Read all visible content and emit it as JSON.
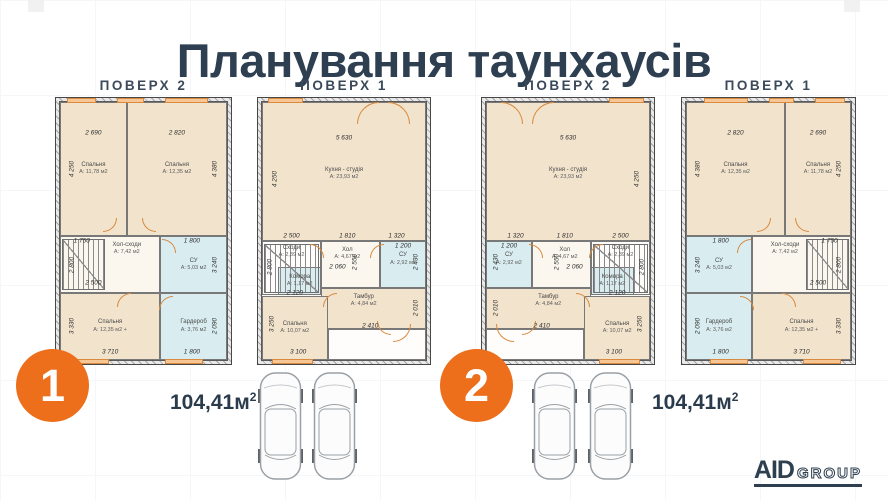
{
  "title": "Планування таунхаусів",
  "brand": {
    "name_bold": "AID",
    "name_outline": "GROUP"
  },
  "units": [
    {
      "badge": "1",
      "area_value": "104,41м",
      "area_sup": "2"
    },
    {
      "badge": "2",
      "area_value": "104,41м",
      "area_sup": "2"
    }
  ],
  "plans": [
    {
      "header": "ПОВЕРХ 2",
      "box": {
        "x": 55,
        "y": 97,
        "w": 177,
        "h": 268
      },
      "stairs": {
        "x": 1,
        "y": 53,
        "w": 26,
        "h": 20
      },
      "rooms": [
        {
          "label": "Спальня",
          "area": "А: 11,78 м2",
          "type": "living",
          "x": 0,
          "y": 0,
          "w": 40,
          "h": 52
        },
        {
          "label": "Спальня",
          "area": "А: 12,35 м2",
          "type": "living",
          "x": 40,
          "y": 0,
          "w": 60,
          "h": 52
        },
        {
          "label": "Хол-сходи",
          "area": "А: 7,42 м2",
          "type": "hall",
          "x": 0,
          "y": 52,
          "w": 60,
          "h": 22,
          "lx": 40,
          "ly": 57
        },
        {
          "label": "СУ",
          "area": "А: 5,03 м2",
          "type": "wet",
          "x": 60,
          "y": 52,
          "w": 40,
          "h": 22
        },
        {
          "label": "Спальня",
          "area": "А: 12,35 м2 +",
          "type": "living",
          "x": 0,
          "y": 74,
          "w": 60,
          "h": 26
        },
        {
          "label": "Гардероб",
          "area": "А: 3,76 м2",
          "type": "wet",
          "x": 60,
          "y": 74,
          "w": 40,
          "h": 26
        }
      ],
      "dims": [
        {
          "t": "2 690",
          "x": 20,
          "y": 12
        },
        {
          "t": "2 820",
          "x": 70,
          "y": 12
        },
        {
          "t": "4 250",
          "x": 7,
          "y": 26,
          "v": 1
        },
        {
          "t": "4 380",
          "x": 93,
          "y": 26,
          "v": 1
        },
        {
          "t": "1 750",
          "x": 13,
          "y": 54
        },
        {
          "t": "1 800",
          "x": 79,
          "y": 54
        },
        {
          "t": "2 800",
          "x": 7,
          "y": 63,
          "v": 1
        },
        {
          "t": "2 500",
          "x": 20,
          "y": 70
        },
        {
          "t": "3 240",
          "x": 93,
          "y": 63,
          "v": 1
        },
        {
          "t": "3 330",
          "x": 7,
          "y": 87,
          "v": 1
        },
        {
          "t": "2 090",
          "x": 93,
          "y": 87,
          "v": 1
        },
        {
          "t": "3 710",
          "x": 30,
          "y": 97
        },
        {
          "t": "1 800",
          "x": 79,
          "y": 97
        }
      ],
      "windows": [
        {
          "s": "top",
          "p": 6,
          "l": 17
        },
        {
          "s": "top",
          "p": 35,
          "l": 15
        },
        {
          "s": "top",
          "p": 62,
          "l": 25
        },
        {
          "s": "bottom",
          "p": 8,
          "l": 22
        },
        {
          "s": "bottom",
          "p": 62,
          "l": 22
        }
      ],
      "doors": [
        {
          "x": 26,
          "y": 45,
          "q": "br"
        },
        {
          "x": 49,
          "y": 45,
          "q": "bl"
        },
        {
          "x": 61,
          "y": 53,
          "q": "tr"
        },
        {
          "x": 34,
          "y": 74,
          "q": "tl"
        },
        {
          "x": 59,
          "y": 75,
          "q": "tl"
        }
      ]
    },
    {
      "header": "ПОВЕРХ 1",
      "box": {
        "x": 257,
        "y": 97,
        "w": 174,
        "h": 268
      },
      "stairs": {
        "x": 1,
        "y": 55,
        "w": 34,
        "h": 19
      },
      "rooms": [
        {
          "label": "Кухня - студія",
          "area": "А: 23,93 м2",
          "type": "living",
          "x": 0,
          "y": 0,
          "w": 100,
          "h": 54,
          "ly": 28
        },
        {
          "label": "Сходи",
          "area": "А: 2,39 м2",
          "type": "open",
          "x": 0,
          "y": 54,
          "w": 36,
          "h": 21,
          "lx": 18,
          "ly": 58
        },
        {
          "label": "Комора",
          "area": "А: 1,17 м2",
          "type": "wet",
          "x": 10,
          "y": 64,
          "w": 26,
          "h": 11
        },
        {
          "label": "Хол",
          "area": "А: 4,67 м2",
          "type": "hall",
          "x": 36,
          "y": 54,
          "w": 36,
          "h": 18,
          "lx": 52,
          "ly": 59
        },
        {
          "label": "СУ",
          "area": "А: 2,92 м2",
          "type": "wet",
          "x": 72,
          "y": 54,
          "w": 28,
          "h": 18,
          "lx": 86,
          "ly": 61
        },
        {
          "label": "Тамбур",
          "area": "А: 4,84 м2",
          "type": "living",
          "x": 36,
          "y": 72,
          "w": 64,
          "h": 16,
          "lx": 62,
          "ly": 77
        },
        {
          "label": "Спальня",
          "area": "А: 10,07 м2",
          "type": "living",
          "x": 0,
          "y": 75,
          "w": 40,
          "h": 25
        },
        {
          "label": "",
          "area": "",
          "type": "open",
          "x": 40,
          "y": 88,
          "w": 60,
          "h": 12
        }
      ],
      "dims": [
        {
          "t": "5 630",
          "x": 50,
          "y": 14
        },
        {
          "t": "4 250",
          "x": 8,
          "y": 30,
          "v": 1
        },
        {
          "t": "2 500",
          "x": 18,
          "y": 52
        },
        {
          "t": "1 810",
          "x": 52,
          "y": 52
        },
        {
          "t": "1 320",
          "x": 82,
          "y": 52
        },
        {
          "t": "1 200",
          "x": 86,
          "y": 56
        },
        {
          "t": "2 800",
          "x": 5,
          "y": 64,
          "v": 1
        },
        {
          "t": "2 550",
          "x": 57,
          "y": 62,
          "v": 1
        },
        {
          "t": "2 060",
          "x": 46,
          "y": 64
        },
        {
          "t": "2 430",
          "x": 94,
          "y": 62,
          "v": 1
        },
        {
          "t": "2 120",
          "x": 20,
          "y": 74
        },
        {
          "t": "2 010",
          "x": 94,
          "y": 80,
          "v": 1
        },
        {
          "t": "2 410",
          "x": 66,
          "y": 87
        },
        {
          "t": "3 250",
          "x": 6,
          "y": 86,
          "v": 1
        },
        {
          "t": "3 100",
          "x": 22,
          "y": 97
        }
      ],
      "windows": [
        {
          "s": "top",
          "p": 6,
          "l": 20
        },
        {
          "s": "bottom",
          "p": 8,
          "l": 24
        }
      ],
      "doors": [
        {
          "x": 58,
          "y": 0,
          "q": "tl",
          "sz": 22
        },
        {
          "x": 77,
          "y": 0,
          "q": "tr",
          "sz": 22
        },
        {
          "x": 66,
          "y": 55,
          "q": "tl"
        },
        {
          "x": 29,
          "y": 55,
          "q": "tr"
        },
        {
          "x": 37,
          "y": 74,
          "q": "tl"
        },
        {
          "x": 70,
          "y": 85,
          "q": "bl"
        },
        {
          "x": 80,
          "y": 86,
          "q": "br",
          "sz": 18
        }
      ]
    },
    {
      "header": "ПОВЕРХ 2",
      "box": {
        "x": 481,
        "y": 97,
        "w": 174,
        "h": 268
      },
      "stairs": {
        "x": 65,
        "y": 55,
        "w": 34,
        "h": 19
      },
      "rooms": [
        {
          "label": "Кухня - студія",
          "area": "А: 23,93 м2",
          "type": "living",
          "x": 0,
          "y": 0,
          "w": 100,
          "h": 54,
          "ly": 28
        },
        {
          "label": "Сходи",
          "area": "А: 2,39 м2",
          "type": "open",
          "x": 64,
          "y": 54,
          "w": 36,
          "h": 21,
          "lx": 82,
          "ly": 58
        },
        {
          "label": "Комора",
          "area": "А: 1,17 м2",
          "type": "wet",
          "x": 64,
          "y": 64,
          "w": 26,
          "h": 11
        },
        {
          "label": "Хол",
          "area": "А: 4,67 м2",
          "type": "hall",
          "x": 28,
          "y": 54,
          "w": 36,
          "h": 18,
          "lx": 48,
          "ly": 59
        },
        {
          "label": "СУ",
          "area": "А: 2,92 м2",
          "type": "wet",
          "x": 0,
          "y": 54,
          "w": 28,
          "h": 18,
          "lx": 14,
          "ly": 61
        },
        {
          "label": "Тамбур",
          "area": "А: 4,84 м2",
          "type": "living",
          "x": 0,
          "y": 72,
          "w": 64,
          "h": 16,
          "lx": 38,
          "ly": 77
        },
        {
          "label": "Спальня",
          "area": "А: 10,07 м2",
          "type": "living",
          "x": 60,
          "y": 75,
          "w": 40,
          "h": 25
        },
        {
          "label": "",
          "area": "",
          "type": "open",
          "x": 0,
          "y": 88,
          "w": 60,
          "h": 12
        }
      ],
      "dims": [
        {
          "t": "5 630",
          "x": 50,
          "y": 14
        },
        {
          "t": "4 250",
          "x": 92,
          "y": 30,
          "v": 1
        },
        {
          "t": "1 320",
          "x": 18,
          "y": 52
        },
        {
          "t": "1 810",
          "x": 48,
          "y": 52
        },
        {
          "t": "2 500",
          "x": 82,
          "y": 52
        },
        {
          "t": "1 200",
          "x": 14,
          "y": 56
        },
        {
          "t": "2 800",
          "x": 95,
          "y": 64,
          "v": 1
        },
        {
          "t": "2 550",
          "x": 43,
          "y": 62,
          "v": 1
        },
        {
          "t": "2 060",
          "x": 54,
          "y": 64
        },
        {
          "t": "2 430",
          "x": 6,
          "y": 62,
          "v": 1
        },
        {
          "t": "2 120",
          "x": 80,
          "y": 74
        },
        {
          "t": "2 010",
          "x": 6,
          "y": 80,
          "v": 1
        },
        {
          "t": "2 410",
          "x": 34,
          "y": 87
        },
        {
          "t": "3 250",
          "x": 94,
          "y": 86,
          "v": 1
        },
        {
          "t": "3 100",
          "x": 78,
          "y": 97
        }
      ],
      "windows": [
        {
          "s": "top",
          "p": 74,
          "l": 20
        },
        {
          "s": "bottom",
          "p": 68,
          "l": 24
        }
      ],
      "doors": [
        {
          "x": 9,
          "y": 0,
          "q": "tr",
          "sz": 22
        },
        {
          "x": 28,
          "y": 0,
          "q": "tl",
          "sz": 22
        },
        {
          "x": 26,
          "y": 55,
          "q": "tr"
        },
        {
          "x": 63,
          "y": 55,
          "q": "tl"
        },
        {
          "x": 55,
          "y": 74,
          "q": "tr"
        },
        {
          "x": 22,
          "y": 85,
          "q": "br"
        },
        {
          "x": 6,
          "y": 86,
          "q": "bl",
          "sz": 18
        }
      ]
    },
    {
      "header": "ПОВЕРХ 1",
      "box": {
        "x": 681,
        "y": 97,
        "w": 175,
        "h": 268
      },
      "stairs": {
        "x": 73,
        "y": 53,
        "w": 26,
        "h": 20
      },
      "rooms": [
        {
          "label": "Спальня",
          "area": "А: 12,35 м2",
          "type": "living",
          "x": 0,
          "y": 0,
          "w": 60,
          "h": 52
        },
        {
          "label": "Спальня",
          "area": "А: 11,78 м2",
          "type": "living",
          "x": 60,
          "y": 0,
          "w": 40,
          "h": 52
        },
        {
          "label": "СУ",
          "area": "А: 5,03 м2",
          "type": "wet",
          "x": 0,
          "y": 52,
          "w": 40,
          "h": 22
        },
        {
          "label": "Хол-сходи",
          "area": "А: 7,42 м2",
          "type": "hall",
          "x": 40,
          "y": 52,
          "w": 60,
          "h": 22,
          "lx": 60,
          "ly": 57
        },
        {
          "label": "Гардероб",
          "area": "А: 3,76 м2",
          "type": "wet",
          "x": 0,
          "y": 74,
          "w": 40,
          "h": 26
        },
        {
          "label": "Спальня",
          "area": "А: 12,35 м2 +",
          "type": "living",
          "x": 40,
          "y": 74,
          "w": 60,
          "h": 26
        }
      ],
      "dims": [
        {
          "t": "2 820",
          "x": 30,
          "y": 12
        },
        {
          "t": "2 690",
          "x": 80,
          "y": 12
        },
        {
          "t": "4 380",
          "x": 7,
          "y": 26,
          "v": 1
        },
        {
          "t": "4 250",
          "x": 93,
          "y": 26,
          "v": 1
        },
        {
          "t": "1 800",
          "x": 21,
          "y": 54
        },
        {
          "t": "1 750",
          "x": 87,
          "y": 54
        },
        {
          "t": "3 240",
          "x": 7,
          "y": 63,
          "v": 1
        },
        {
          "t": "2 800",
          "x": 93,
          "y": 63,
          "v": 1
        },
        {
          "t": "2 500",
          "x": 80,
          "y": 70
        },
        {
          "t": "2 090",
          "x": 7,
          "y": 87,
          "v": 1
        },
        {
          "t": "3 330",
          "x": 93,
          "y": 87,
          "v": 1
        },
        {
          "t": "1 800",
          "x": 21,
          "y": 97
        },
        {
          "t": "3 710",
          "x": 70,
          "y": 97
        }
      ],
      "windows": [
        {
          "s": "top",
          "p": 13,
          "l": 25
        },
        {
          "s": "top",
          "p": 50,
          "l": 15
        },
        {
          "s": "top",
          "p": 77,
          "l": 17
        },
        {
          "s": "bottom",
          "p": 16,
          "l": 22
        },
        {
          "s": "bottom",
          "p": 70,
          "l": 22
        }
      ],
      "doors": [
        {
          "x": 43,
          "y": 45,
          "q": "br"
        },
        {
          "x": 66,
          "y": 45,
          "q": "bl"
        },
        {
          "x": 31,
          "y": 53,
          "q": "tl"
        },
        {
          "x": 58,
          "y": 74,
          "q": "tr"
        },
        {
          "x": 33,
          "y": 75,
          "q": "tr"
        }
      ]
    }
  ]
}
